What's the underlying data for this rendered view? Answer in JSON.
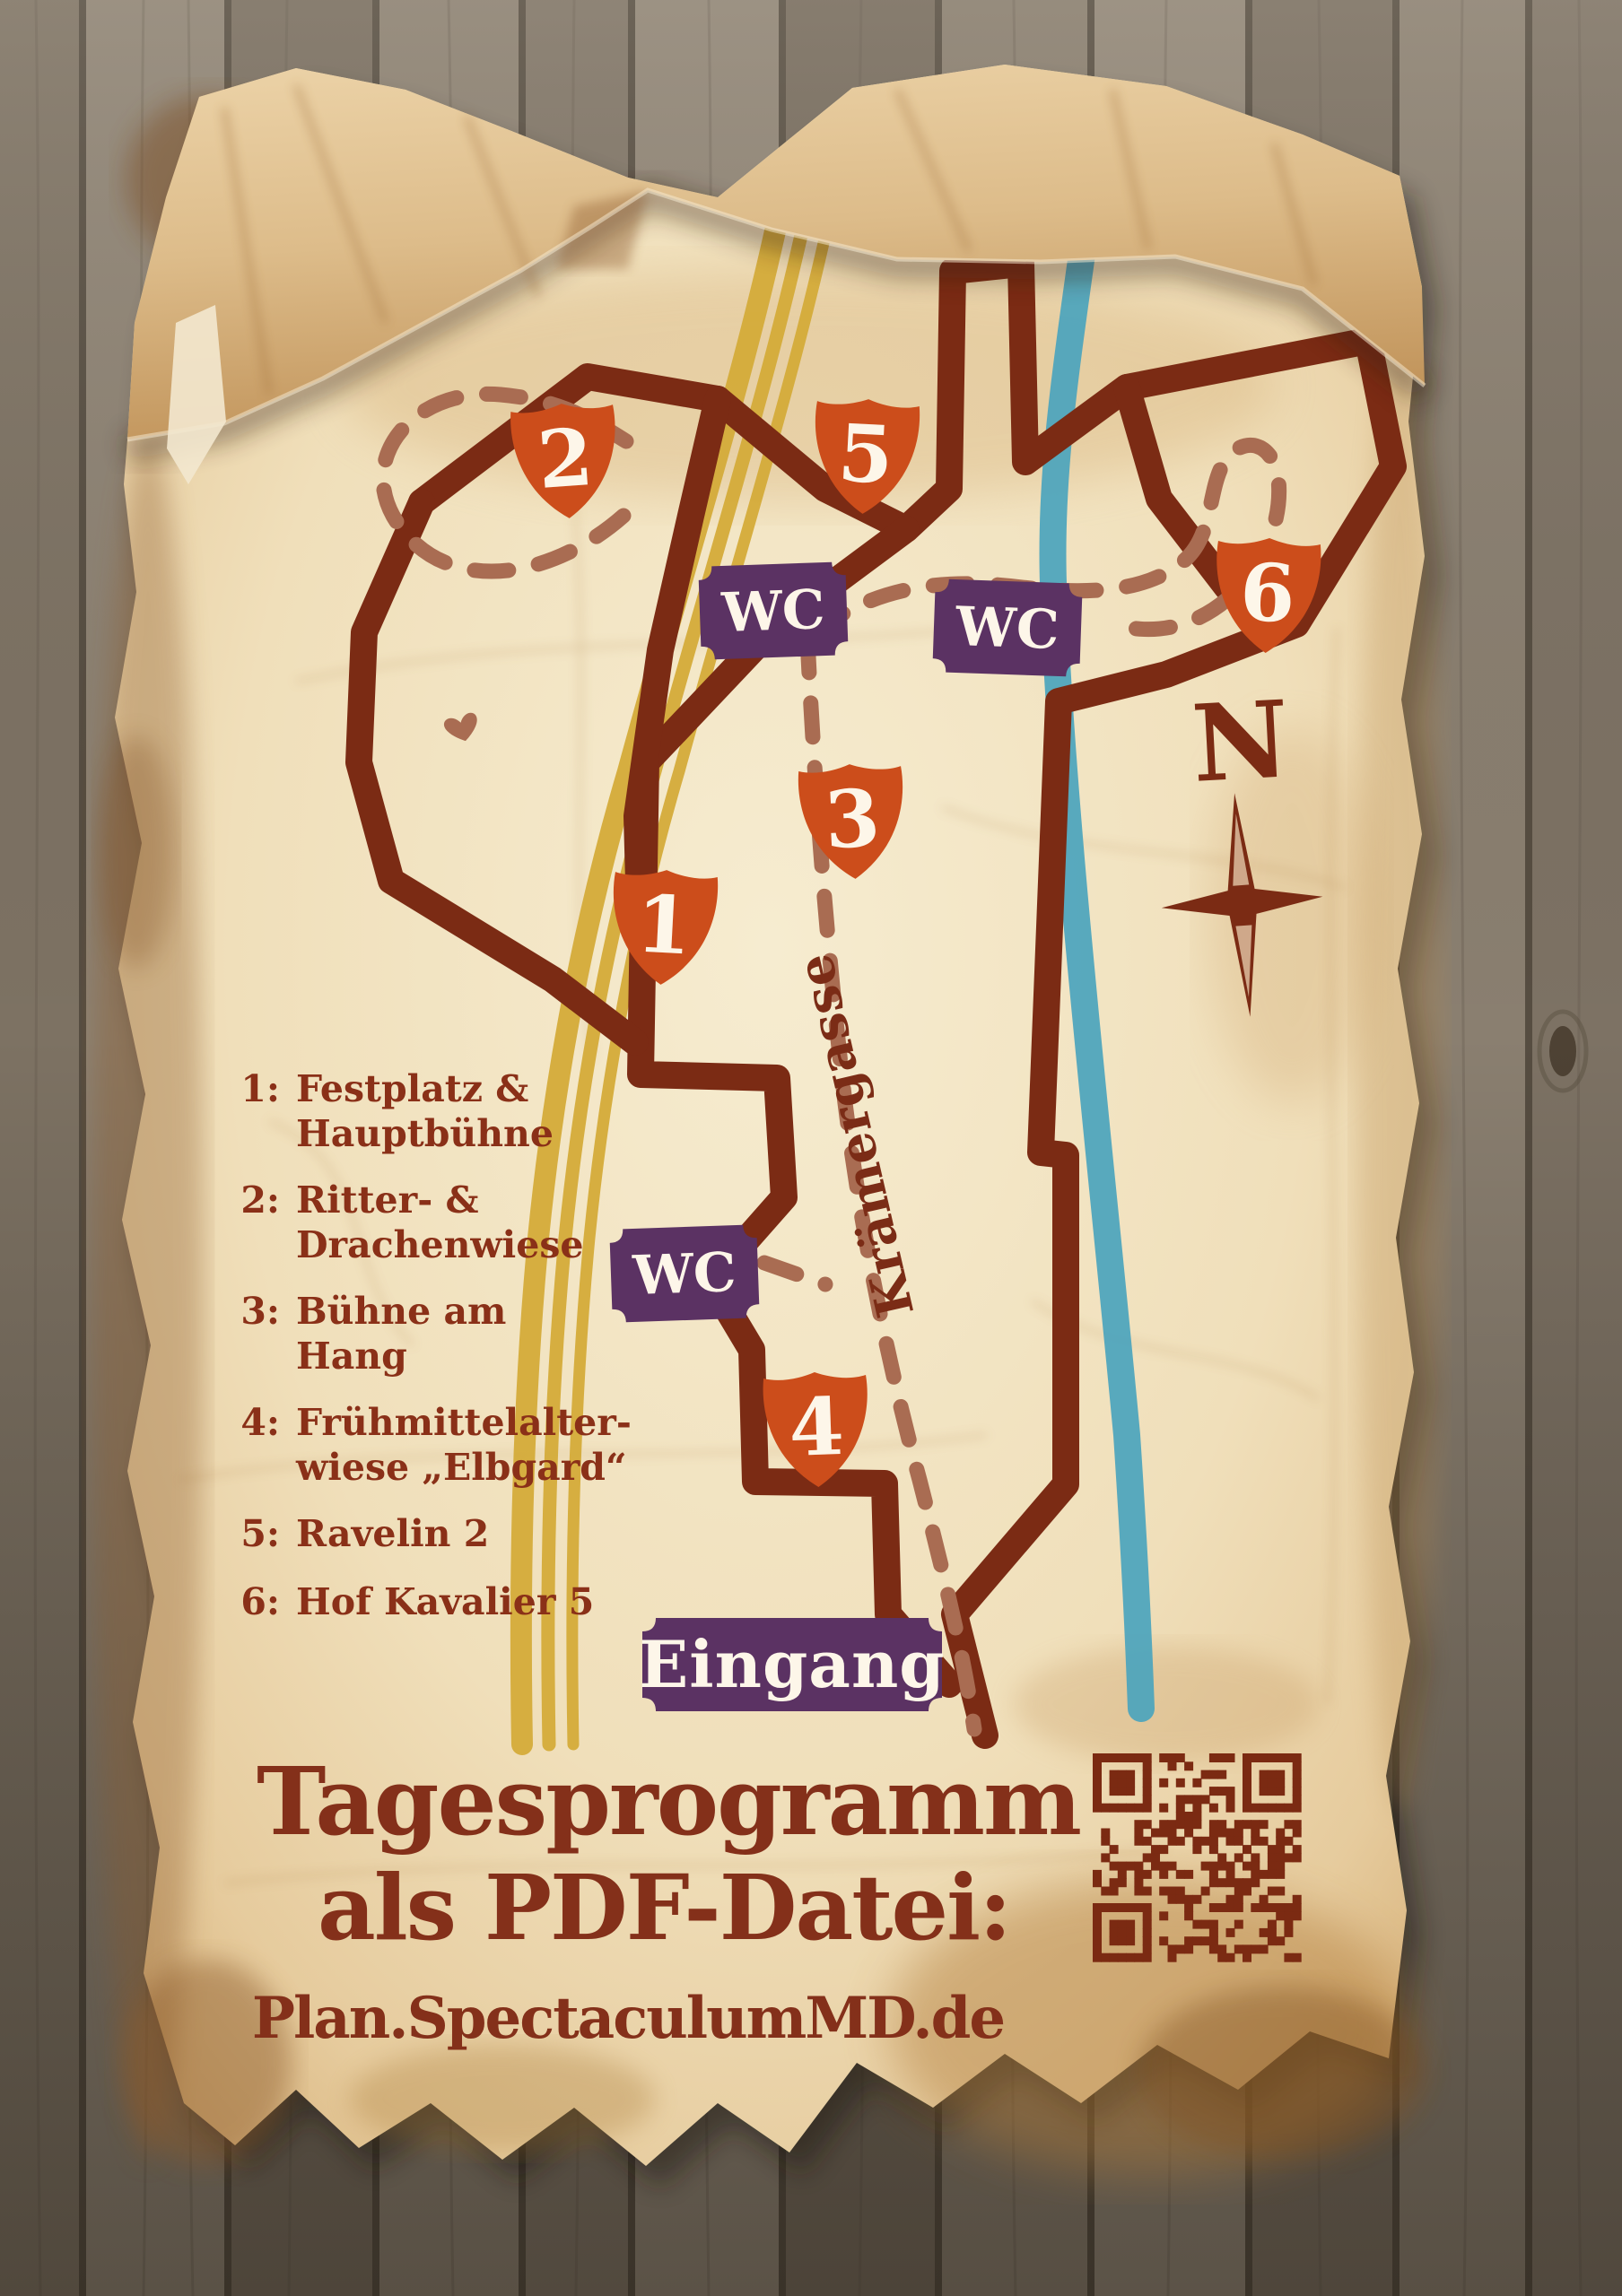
{
  "poster": {
    "map": {
      "markers": [
        {
          "id": "1",
          "label": "1"
        },
        {
          "id": "2",
          "label": "2"
        },
        {
          "id": "3",
          "label": "3"
        },
        {
          "id": "4",
          "label": "4"
        },
        {
          "id": "5",
          "label": "5"
        },
        {
          "id": "6",
          "label": "6"
        }
      ],
      "wc_labels": [
        "WC",
        "WC",
        "WC"
      ],
      "entrance_label": "Eingang",
      "street_label": "Krämergasse",
      "compass_label": "N"
    },
    "legend": {
      "items": [
        {
          "num": "1:",
          "lines": [
            "Festplatz &",
            "Hauptbühne"
          ]
        },
        {
          "num": "2:",
          "lines": [
            "Ritter- &",
            "Drachenwiese"
          ]
        },
        {
          "num": "3:",
          "lines": [
            "Bühne am",
            "Hang"
          ]
        },
        {
          "num": "4:",
          "lines": [
            "Frühmittelalter-",
            "wiese „Elbgard“"
          ]
        },
        {
          "num": "5:",
          "lines": [
            "Ravelin 2",
            ""
          ]
        },
        {
          "num": "6:",
          "lines": [
            "Hof Kavalier 5",
            ""
          ]
        }
      ]
    },
    "footer": {
      "title_line1": "Tagesprogramm",
      "title_line2": "als PDF-Datei:",
      "url": "Plan.SpectaculumMD.de"
    },
    "colors": {
      "parchment": "#f0dfba",
      "outline_brown": "#7b2b14",
      "trail_dash": "#a96c52",
      "road_yellow": "#d4ab39",
      "river_blue": "#4ba4bd",
      "shield_orange": "#cc4d1b",
      "plaque_purple": "#5b3263",
      "text_brown": "#8a3018"
    }
  }
}
